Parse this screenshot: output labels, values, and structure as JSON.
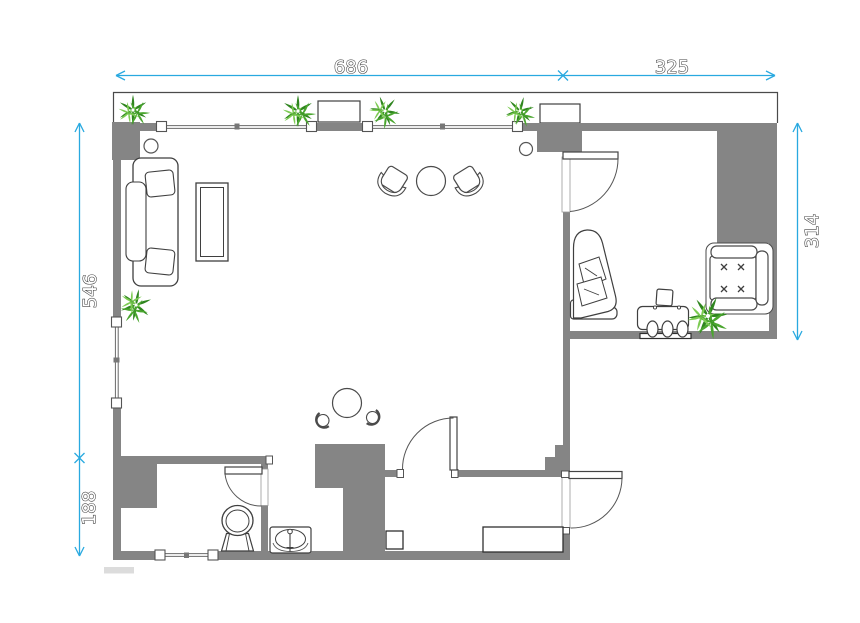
{
  "title": "Apartment floor plan",
  "canvas": {
    "width": 860,
    "height": 623,
    "background": "#ffffff"
  },
  "colors": {
    "wall": "#858585",
    "dimension_line": "#29a9e0",
    "furniture_outline": "#3f3f3f",
    "window_line": "#6a6a6a",
    "plant_dark": "#2f851f",
    "plant_mid": "#4aa62e",
    "plant_light": "#7ccb52"
  },
  "dimensions": {
    "top_left": {
      "value": "686",
      "orientation": "horizontal",
      "edge": "top"
    },
    "top_right": {
      "value": "325",
      "orientation": "horizontal",
      "edge": "top"
    },
    "left_upper": {
      "value": "546",
      "orientation": "vertical",
      "edge": "left"
    },
    "left_lower": {
      "value": "188",
      "orientation": "vertical",
      "edge": "left"
    },
    "right_side": {
      "value": "314",
      "orientation": "vertical",
      "edge": "right"
    }
  },
  "rooms": [
    "living-room",
    "study",
    "bathroom",
    "washbasin-nook",
    "hallway",
    "balcony"
  ],
  "furniture": [
    "sofa",
    "coffee-table",
    "tub-chair",
    "round-table",
    "bistro-table",
    "stool",
    "toilet",
    "sink",
    "shoe-cabinet",
    "storage-box",
    "chaise-longue",
    "desk",
    "desk-chair",
    "tufted-armchair",
    "planter-box",
    "potted-plant",
    "ceiling-light"
  ]
}
